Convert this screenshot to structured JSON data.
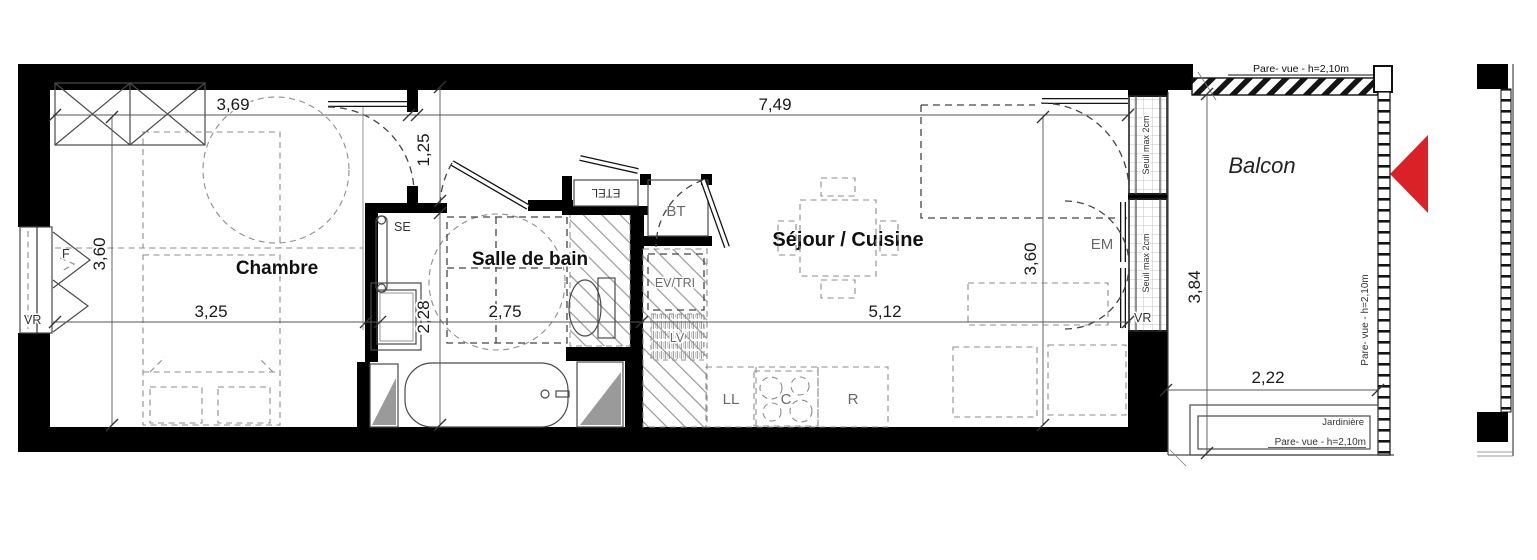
{
  "plan": {
    "rooms": {
      "chambre": "Chambre",
      "salle_de_bain": "Salle de bain",
      "sejour_cuisine": "Séjour / Cuisine",
      "balcon": "Balcon"
    },
    "dimensions": {
      "chambre_top": "3,69",
      "hall": "1,25",
      "sejour_top": "7,49",
      "chambre_side": "3,60",
      "chambre_bottom": "3,25",
      "sdb_side": "2,28",
      "sdb_bottom": "2,75",
      "sejour_bottom": "5,12",
      "sejour_side": "3,60",
      "balcon_side": "3,84",
      "balcon_bottom": "2,22"
    },
    "labels": {
      "window_f": "F",
      "shutter_left": "VR",
      "towel_dryer": "SE",
      "etel": "ETEL",
      "bt": "BT",
      "ev_tri": "EV/TRI",
      "lv": "LV",
      "ll": "LL",
      "cooktop": "C",
      "fridge": "R",
      "em": "EM",
      "shutter_right": "VR"
    },
    "annotations": {
      "seuil_upper": "Seuil max 2cm",
      "seuil_lower": "Seuil max 2cm",
      "pare_vue_top": "Pare- vue - h=2,10m",
      "pare_vue_right": "Pare- vue - h=2,10m",
      "jardiniere": "Jardinière",
      "pare_vue_jardiniere": "Pare- vue - h=2,10m"
    },
    "colors": {
      "wall": "#000000",
      "arrow_red": "#da2128",
      "shaft_gray": "#9a9a9a"
    }
  }
}
